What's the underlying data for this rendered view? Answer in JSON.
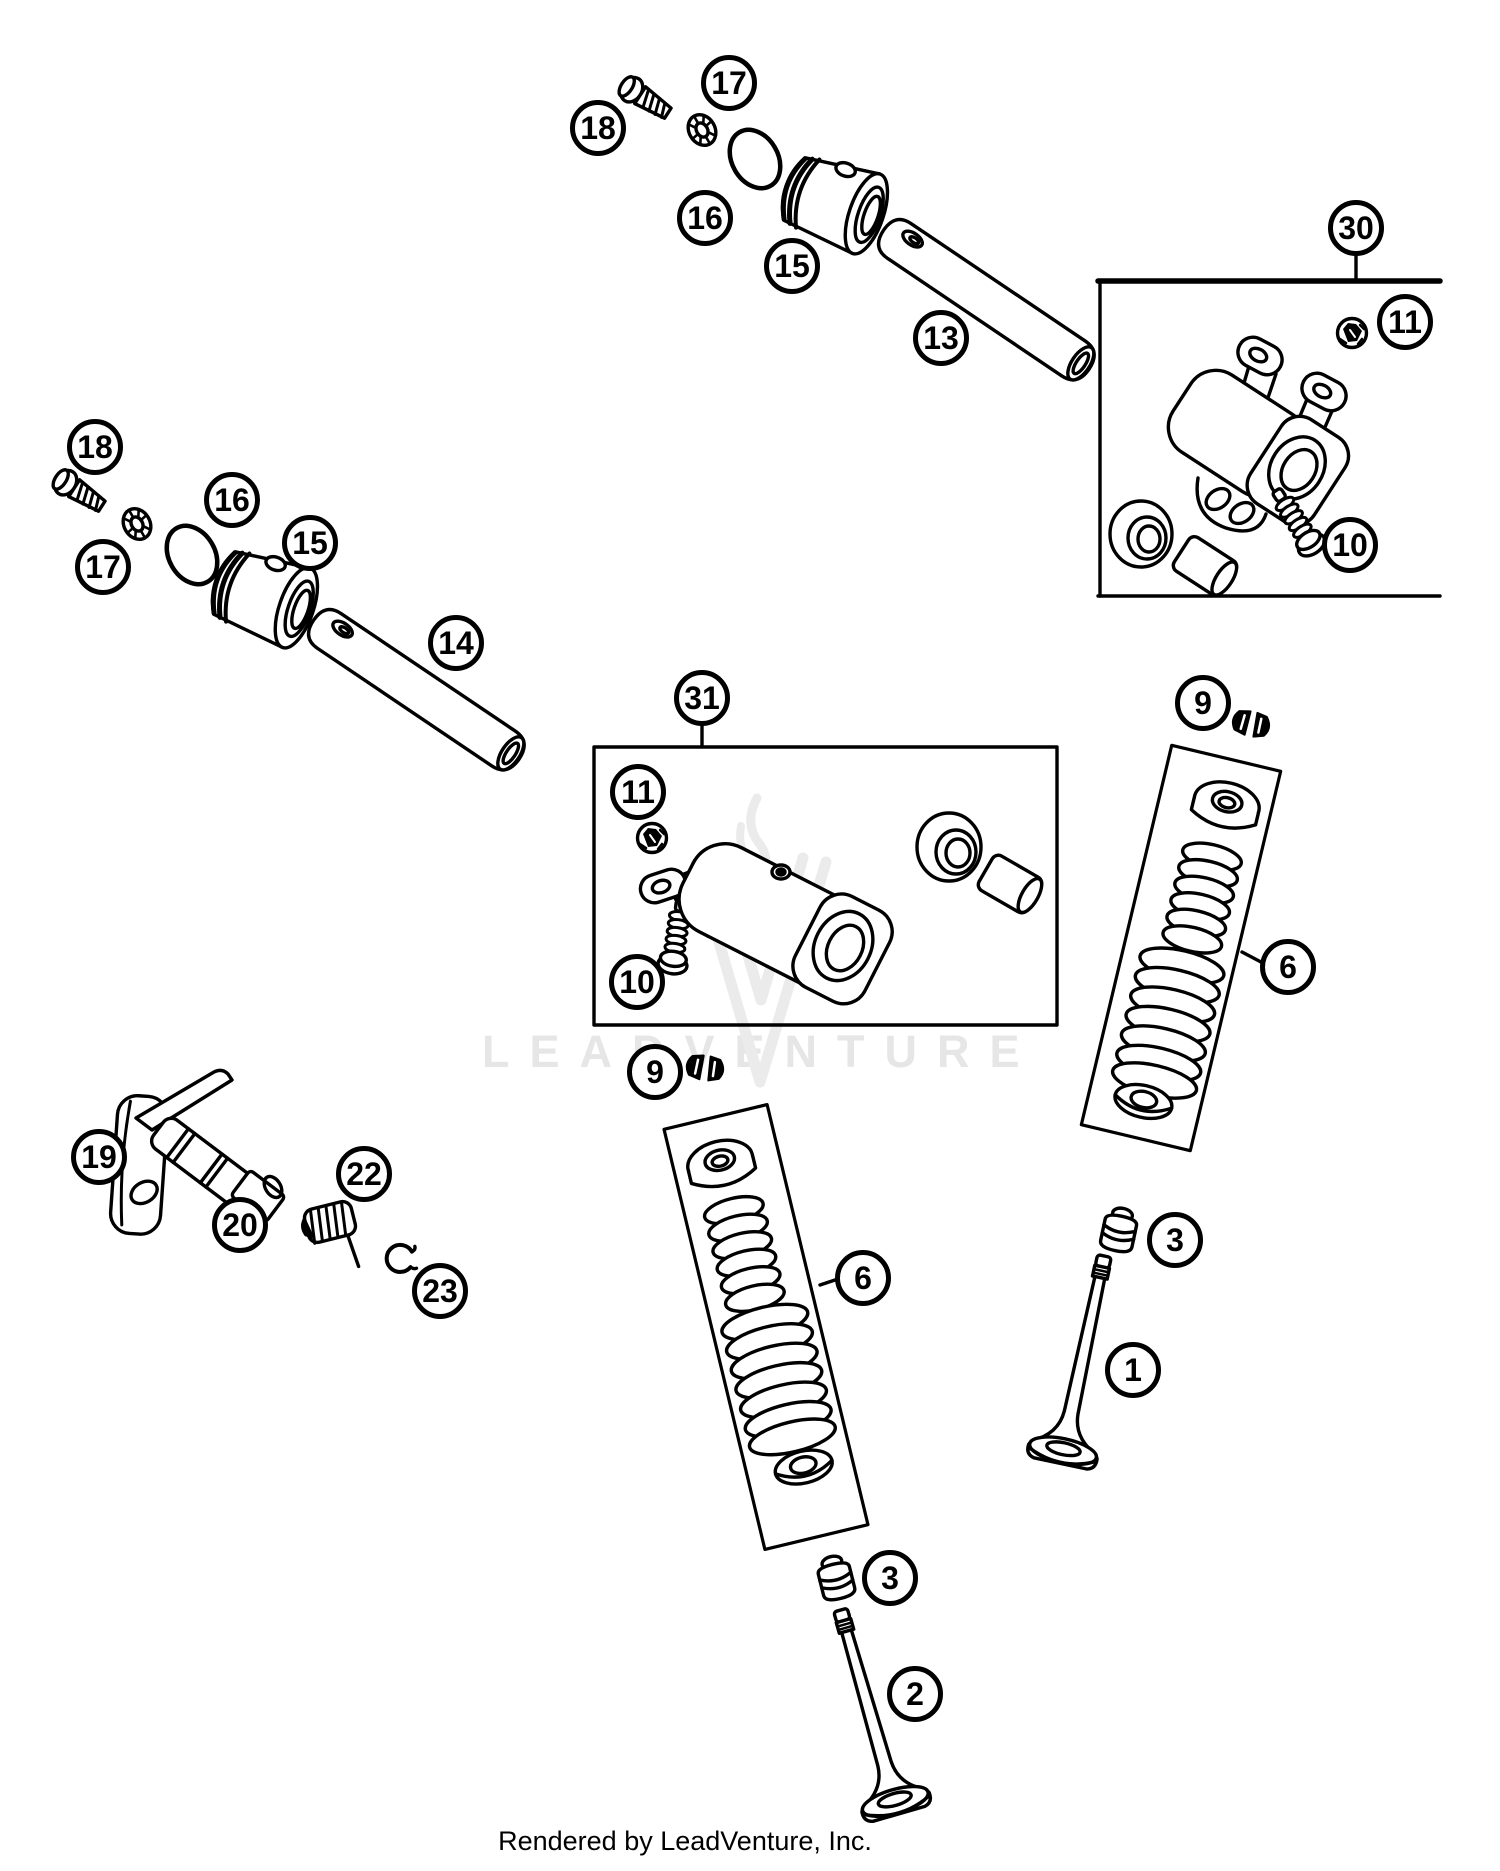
{
  "page": {
    "background": "#ffffff",
    "ink_color": "#000000",
    "watermark_text": "LEADVENTURE",
    "watermark_color": "#e6e6e6",
    "footer_text": "Rendered by LeadVenture, Inc."
  },
  "callouts": [
    {
      "label": "18",
      "x": 598,
      "y": 128
    },
    {
      "label": "17",
      "x": 729,
      "y": 83
    },
    {
      "label": "16",
      "x": 705,
      "y": 218
    },
    {
      "label": "15",
      "x": 792,
      "y": 266
    },
    {
      "label": "13",
      "x": 941,
      "y": 338
    },
    {
      "label": "30",
      "x": 1356,
      "y": 228
    },
    {
      "label": "11",
      "x": 1405,
      "y": 322
    },
    {
      "label": "10",
      "x": 1350,
      "y": 545
    },
    {
      "label": "18",
      "x": 95,
      "y": 447
    },
    {
      "label": "17",
      "x": 103,
      "y": 567
    },
    {
      "label": "16",
      "x": 232,
      "y": 500
    },
    {
      "label": "15",
      "x": 310,
      "y": 543
    },
    {
      "label": "14",
      "x": 456,
      "y": 643
    },
    {
      "label": "31",
      "x": 702,
      "y": 698
    },
    {
      "label": "11",
      "x": 638,
      "y": 792
    },
    {
      "label": "10",
      "x": 637,
      "y": 982
    },
    {
      "label": "9",
      "x": 1203,
      "y": 703
    },
    {
      "label": "6",
      "x": 1288,
      "y": 967
    },
    {
      "label": "3",
      "x": 1175,
      "y": 1240
    },
    {
      "label": "1",
      "x": 1133,
      "y": 1370
    },
    {
      "label": "9",
      "x": 655,
      "y": 1072
    },
    {
      "label": "6",
      "x": 863,
      "y": 1278
    },
    {
      "label": "3",
      "x": 890,
      "y": 1578
    },
    {
      "label": "2",
      "x": 915,
      "y": 1694
    },
    {
      "label": "19",
      "x": 99,
      "y": 1157
    },
    {
      "label": "20",
      "x": 240,
      "y": 1225
    },
    {
      "label": "22",
      "x": 364,
      "y": 1174
    },
    {
      "label": "23",
      "x": 440,
      "y": 1291
    }
  ]
}
